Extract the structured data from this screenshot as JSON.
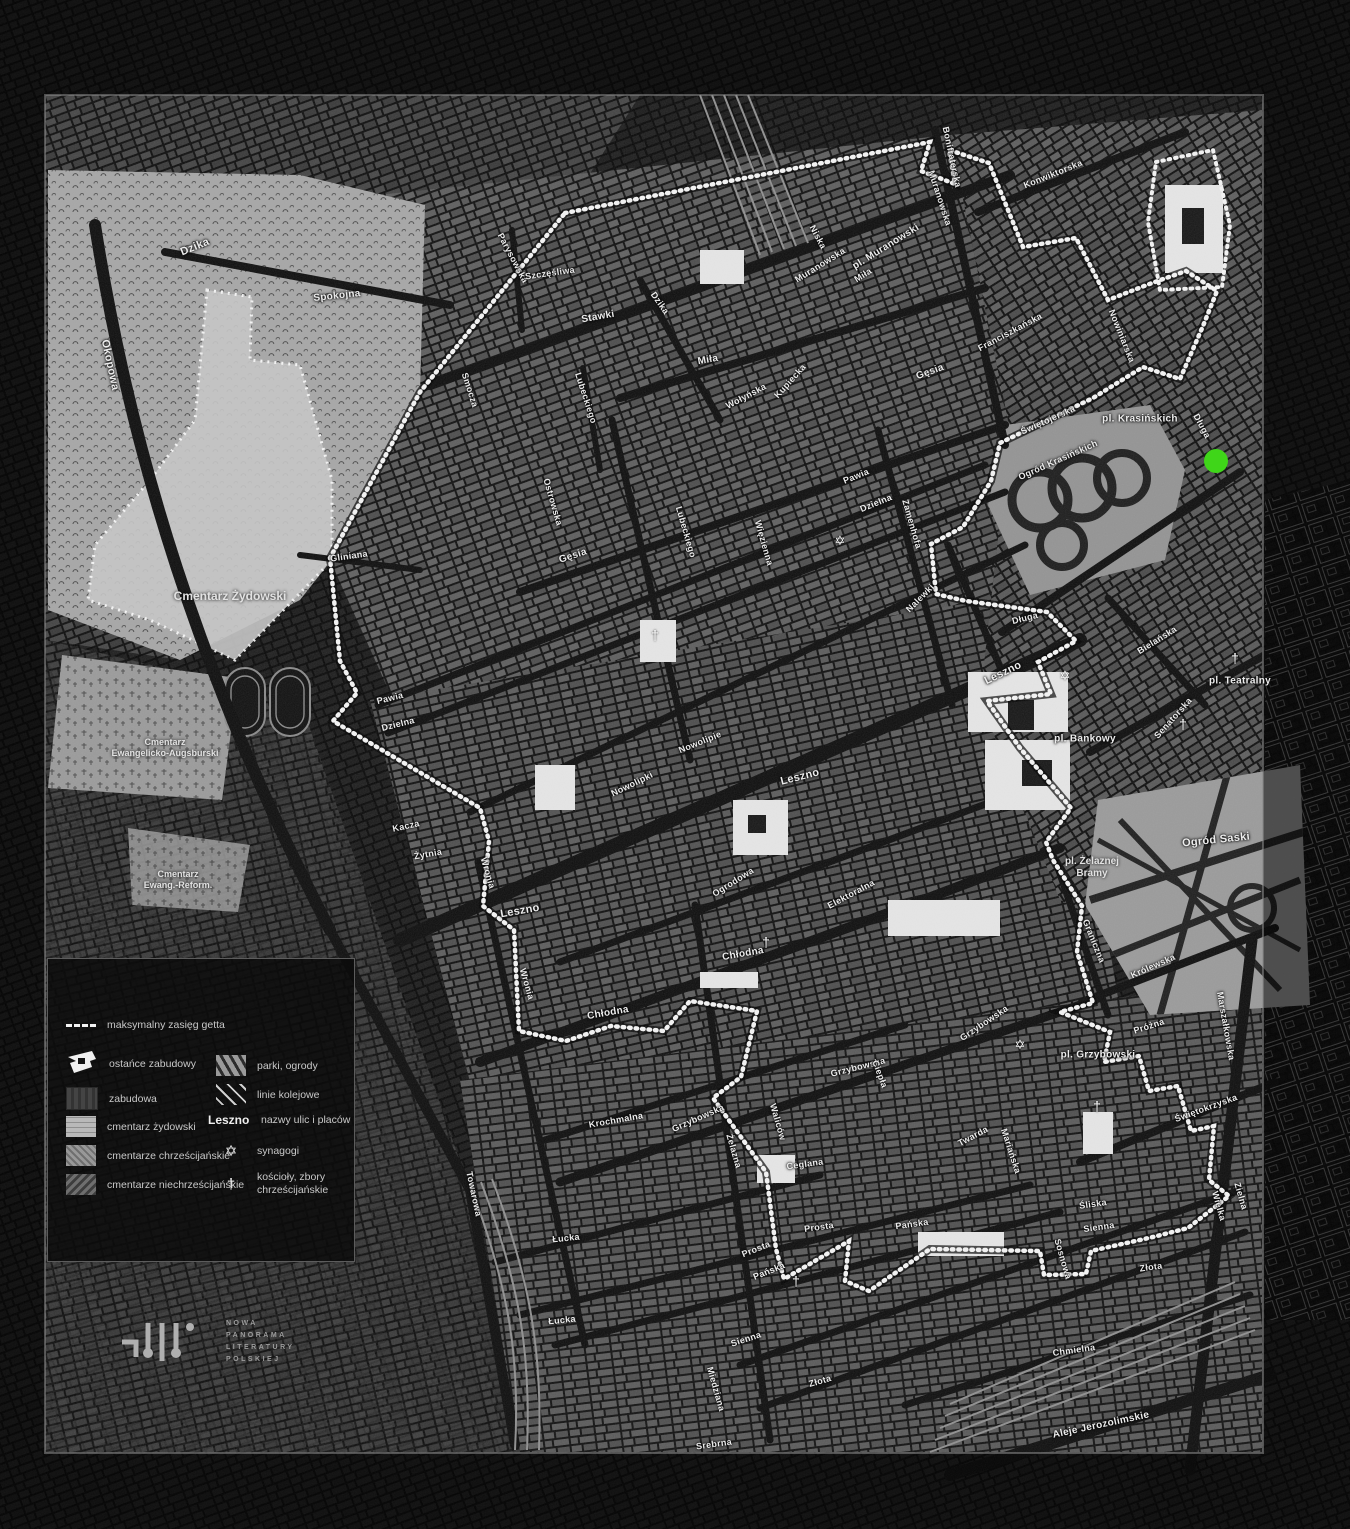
{
  "map": {
    "marker": {
      "name": "location-marker",
      "color": "#3fd619",
      "x": 1216,
      "y": 461,
      "diameter": 24
    },
    "street_labels": [
      {
        "t": "Dzika",
        "x": 195,
        "y": 247,
        "r": -22,
        "s": 11
      },
      {
        "t": "Okopowa",
        "x": 110,
        "y": 365,
        "r": 78,
        "s": 11
      },
      {
        "t": "Spokojna",
        "x": 337,
        "y": 296,
        "r": -6,
        "s": 10
      },
      {
        "t": "Parysowska",
        "x": 513,
        "y": 258,
        "r": 62,
        "s": 9
      },
      {
        "t": "Szczęśliwa",
        "x": 550,
        "y": 273,
        "r": -8,
        "s": 9
      },
      {
        "t": "Stawki",
        "x": 598,
        "y": 317,
        "r": -10,
        "s": 10
      },
      {
        "t": "Dzika",
        "x": 660,
        "y": 303,
        "r": 55,
        "s": 9
      },
      {
        "t": "Lubeckiego",
        "x": 586,
        "y": 398,
        "r": 72,
        "s": 9
      },
      {
        "t": "Smocza",
        "x": 470,
        "y": 390,
        "r": 72,
        "s": 9
      },
      {
        "t": "Niska",
        "x": 818,
        "y": 237,
        "r": 62,
        "s": 9
      },
      {
        "t": "Muranowska",
        "x": 820,
        "y": 265,
        "r": -32,
        "s": 9
      },
      {
        "t": "pl. Muranowski",
        "x": 886,
        "y": 247,
        "r": -32,
        "s": 10
      },
      {
        "t": "Miła",
        "x": 863,
        "y": 275,
        "r": -32,
        "s": 9
      },
      {
        "t": "Muranowska",
        "x": 940,
        "y": 198,
        "r": 72,
        "s": 9
      },
      {
        "t": "Bonifraterska",
        "x": 952,
        "y": 157,
        "r": 78,
        "s": 9
      },
      {
        "t": "Konwiktorska",
        "x": 1053,
        "y": 174,
        "r": -22,
        "s": 9
      },
      {
        "t": "Miła",
        "x": 708,
        "y": 360,
        "r": -10,
        "s": 10
      },
      {
        "t": "Wołyńska",
        "x": 746,
        "y": 396,
        "r": -28,
        "s": 9
      },
      {
        "t": "Kupiecka",
        "x": 790,
        "y": 381,
        "r": -48,
        "s": 9
      },
      {
        "t": "Gęsia",
        "x": 573,
        "y": 556,
        "r": -18,
        "s": 10
      },
      {
        "t": "Gęsia",
        "x": 930,
        "y": 372,
        "r": -20,
        "s": 10
      },
      {
        "t": "Ostrowska",
        "x": 553,
        "y": 502,
        "r": 74,
        "s": 9
      },
      {
        "t": "Lubeckiego",
        "x": 686,
        "y": 532,
        "r": 74,
        "s": 9
      },
      {
        "t": "Więzienna",
        "x": 764,
        "y": 543,
        "r": 74,
        "s": 9
      },
      {
        "t": "Zamenhofa",
        "x": 912,
        "y": 524,
        "r": 74,
        "s": 9
      },
      {
        "t": "Pawia",
        "x": 856,
        "y": 476,
        "r": -22,
        "s": 9
      },
      {
        "t": "Dzielna",
        "x": 876,
        "y": 503,
        "r": -22,
        "s": 9
      },
      {
        "t": "Franciszkańska",
        "x": 1010,
        "y": 332,
        "r": -28,
        "s": 9
      },
      {
        "t": "Nowiniarska",
        "x": 1122,
        "y": 336,
        "r": 68,
        "s": 9
      },
      {
        "t": "Świętojerska",
        "x": 1048,
        "y": 420,
        "r": -24,
        "s": 9
      },
      {
        "t": "pl. Krasińskich",
        "x": 1140,
        "y": 419,
        "r": 0,
        "s": 10
      },
      {
        "t": "Długa",
        "x": 1202,
        "y": 426,
        "r": 62,
        "s": 9
      },
      {
        "t": "Gliniana",
        "x": 349,
        "y": 556,
        "r": -8,
        "s": 9
      },
      {
        "t": "Pawia",
        "x": 390,
        "y": 698,
        "r": -14,
        "s": 9
      },
      {
        "t": "Dzielna",
        "x": 398,
        "y": 724,
        "r": -14,
        "s": 9
      },
      {
        "t": "Kacza",
        "x": 406,
        "y": 826,
        "r": -12,
        "s": 9
      },
      {
        "t": "Żytnia",
        "x": 428,
        "y": 854,
        "r": -10,
        "s": 9
      },
      {
        "t": "Wronia",
        "x": 488,
        "y": 873,
        "r": 74,
        "s": 9
      },
      {
        "t": "Nowolipki",
        "x": 632,
        "y": 784,
        "r": -26,
        "s": 9
      },
      {
        "t": "Nowolipie",
        "x": 700,
        "y": 742,
        "r": -22,
        "s": 9
      },
      {
        "t": "Nalewki",
        "x": 920,
        "y": 598,
        "r": -45,
        "s": 9
      },
      {
        "t": "Leszno",
        "x": 1003,
        "y": 673,
        "r": -26,
        "s": 11
      },
      {
        "t": "Leszno",
        "x": 800,
        "y": 777,
        "r": -14,
        "s": 11
      },
      {
        "t": "Leszno",
        "x": 520,
        "y": 911,
        "r": -10,
        "s": 11
      },
      {
        "t": "Długa",
        "x": 1025,
        "y": 618,
        "r": -14,
        "s": 9
      },
      {
        "t": "Bielańska",
        "x": 1157,
        "y": 640,
        "r": -32,
        "s": 9
      },
      {
        "t": "pl. Teatralny",
        "x": 1240,
        "y": 681,
        "r": 0,
        "s": 10
      },
      {
        "t": "Senatorska",
        "x": 1173,
        "y": 718,
        "r": -48,
        "s": 9
      },
      {
        "t": "pl. Bankowy",
        "x": 1085,
        "y": 739,
        "r": 0,
        "s": 10
      },
      {
        "t": "Ogrodowa",
        "x": 733,
        "y": 882,
        "r": -32,
        "s": 9
      },
      {
        "t": "Elektoralna",
        "x": 851,
        "y": 894,
        "r": -28,
        "s": 9
      },
      {
        "t": "Chłodna",
        "x": 743,
        "y": 954,
        "r": -10,
        "s": 10
      },
      {
        "t": "Chłodna",
        "x": 608,
        "y": 1013,
        "r": -10,
        "s": 10
      },
      {
        "t": "Wronia",
        "x": 527,
        "y": 984,
        "r": 74,
        "s": 9
      },
      {
        "t": "Krochmalna",
        "x": 616,
        "y": 1120,
        "r": -10,
        "s": 9
      },
      {
        "t": "Grzybowska",
        "x": 858,
        "y": 1067,
        "r": -14,
        "s": 9
      },
      {
        "t": "Grzybowska",
        "x": 984,
        "y": 1023,
        "r": -34,
        "s": 9
      },
      {
        "t": "Grzybowska",
        "x": 698,
        "y": 1118,
        "r": -24,
        "s": 9
      },
      {
        "t": "Ciepła",
        "x": 880,
        "y": 1074,
        "r": 70,
        "s": 9
      },
      {
        "t": "Żelazna",
        "x": 734,
        "y": 1151,
        "r": 74,
        "s": 9
      },
      {
        "t": "Waliców",
        "x": 778,
        "y": 1122,
        "r": 74,
        "s": 9
      },
      {
        "t": "Ceglana",
        "x": 805,
        "y": 1164,
        "r": -8,
        "s": 9
      },
      {
        "t": "Prosta",
        "x": 819,
        "y": 1227,
        "r": -8,
        "s": 9
      },
      {
        "t": "Prosta",
        "x": 756,
        "y": 1249,
        "r": -22,
        "s": 9
      },
      {
        "t": "Pańska",
        "x": 912,
        "y": 1224,
        "r": -8,
        "s": 9
      },
      {
        "t": "Pańska",
        "x": 769,
        "y": 1271,
        "r": -22,
        "s": 9
      },
      {
        "t": "Twarda",
        "x": 973,
        "y": 1136,
        "r": -28,
        "s": 9
      },
      {
        "t": "Mariańska",
        "x": 1011,
        "y": 1151,
        "r": 72,
        "s": 9
      },
      {
        "t": "Śliska",
        "x": 1093,
        "y": 1204,
        "r": -8,
        "s": 9
      },
      {
        "t": "Sienna",
        "x": 1099,
        "y": 1227,
        "r": -8,
        "s": 9
      },
      {
        "t": "Sienna",
        "x": 746,
        "y": 1339,
        "r": -18,
        "s": 9
      },
      {
        "t": "Złota",
        "x": 1151,
        "y": 1267,
        "r": -8,
        "s": 9
      },
      {
        "t": "Złota",
        "x": 820,
        "y": 1381,
        "r": -16,
        "s": 9
      },
      {
        "t": "Chmielna",
        "x": 1074,
        "y": 1350,
        "r": -8,
        "s": 9
      },
      {
        "t": "Sosnowa",
        "x": 1063,
        "y": 1259,
        "r": 74,
        "s": 9
      },
      {
        "t": "Wielka",
        "x": 1219,
        "y": 1206,
        "r": 74,
        "s": 9
      },
      {
        "t": "Zielna",
        "x": 1241,
        "y": 1196,
        "r": 74,
        "s": 9
      },
      {
        "t": "Świętokrzyska",
        "x": 1206,
        "y": 1108,
        "r": -20,
        "s": 9
      },
      {
        "t": "Marszałkowska",
        "x": 1226,
        "y": 1026,
        "r": 80,
        "s": 9
      },
      {
        "t": "Królewska",
        "x": 1153,
        "y": 966,
        "r": -24,
        "s": 9
      },
      {
        "t": "Graniczna",
        "x": 1094,
        "y": 941,
        "r": 68,
        "s": 9
      },
      {
        "t": "Próżna",
        "x": 1149,
        "y": 1026,
        "r": -18,
        "s": 9
      },
      {
        "t": "pl. Grzybowski",
        "x": 1098,
        "y": 1055,
        "r": 0,
        "s": 10
      },
      {
        "t": "Ogród Saski",
        "x": 1216,
        "y": 840,
        "r": -6,
        "s": 11
      },
      {
        "t": "Ogród Krasińskich",
        "x": 1058,
        "y": 460,
        "r": -24,
        "s": 9
      },
      {
        "t": "Miedziana",
        "x": 716,
        "y": 1389,
        "r": 74,
        "s": 9
      },
      {
        "t": "Srebrna",
        "x": 714,
        "y": 1444,
        "r": -8,
        "s": 9
      },
      {
        "t": "Łucka",
        "x": 566,
        "y": 1238,
        "r": -6,
        "s": 9
      },
      {
        "t": "Łucka",
        "x": 562,
        "y": 1320,
        "r": -6,
        "s": 9
      },
      {
        "t": "Towarowa",
        "x": 474,
        "y": 1194,
        "r": 78,
        "s": 9
      },
      {
        "t": "Aleje Jerozolimskie",
        "x": 1101,
        "y": 1425,
        "r": -12,
        "s": 10
      }
    ],
    "place_labels": [
      {
        "lines": [
          "Cmentarz Żydowski"
        ],
        "x": 230,
        "y": 596,
        "s": 12
      },
      {
        "lines": [
          "Cmentarz",
          "Ewangelicko-Augsburski"
        ],
        "x": 165,
        "y": 748,
        "s": 9
      },
      {
        "lines": [
          "Cmentarz",
          "Ewang.-Reform."
        ],
        "x": 178,
        "y": 880,
        "s": 9
      },
      {
        "lines": [
          "pl. Żelaznej",
          "Bramy"
        ],
        "x": 1092,
        "y": 868,
        "s": 10
      }
    ],
    "synagogue_points": [
      {
        "x": 840,
        "y": 541
      },
      {
        "x": 1065,
        "y": 676
      },
      {
        "x": 1020,
        "y": 1045
      }
    ],
    "church_points": [
      {
        "x": 655,
        "y": 635
      },
      {
        "x": 766,
        "y": 942
      },
      {
        "x": 1235,
        "y": 658
      },
      {
        "x": 1183,
        "y": 724
      },
      {
        "x": 796,
        "y": 1281
      },
      {
        "x": 1097,
        "y": 1106
      }
    ]
  },
  "legend": {
    "items": [
      {
        "id": "ghetto-extent",
        "label": "maksymalny zasięg getta"
      },
      {
        "id": "ostance",
        "label": "ostańce zabudowy"
      },
      {
        "id": "zabudowa",
        "label": "zabudowa"
      },
      {
        "id": "cmentarz-zydowski",
        "label": "cmentarz żydowski"
      },
      {
        "id": "cmentarze-chrzescijanskie",
        "label": "cmentarze chrześcijańskie"
      },
      {
        "id": "cmentarze-niechrzescijanskie",
        "label": "cmentarze niechrześcijańskie"
      },
      {
        "id": "parki-ogrody",
        "label": "parki, ogrody"
      },
      {
        "id": "linie-kolejowe",
        "label": "linie kolejowe"
      },
      {
        "id": "nazwy-ulic",
        "sample": "Leszno",
        "label": "nazwy ulic i placów"
      },
      {
        "id": "synagogi",
        "glyph": "✡",
        "label": "synagogi"
      },
      {
        "id": "koscioly",
        "glyph": "†",
        "label": "kościoły, zbory chrześcijańskie"
      }
    ]
  },
  "logo": {
    "lines": [
      "NOWA",
      "PANORAMA",
      "LITERATURY",
      "POLSKIEJ"
    ]
  }
}
